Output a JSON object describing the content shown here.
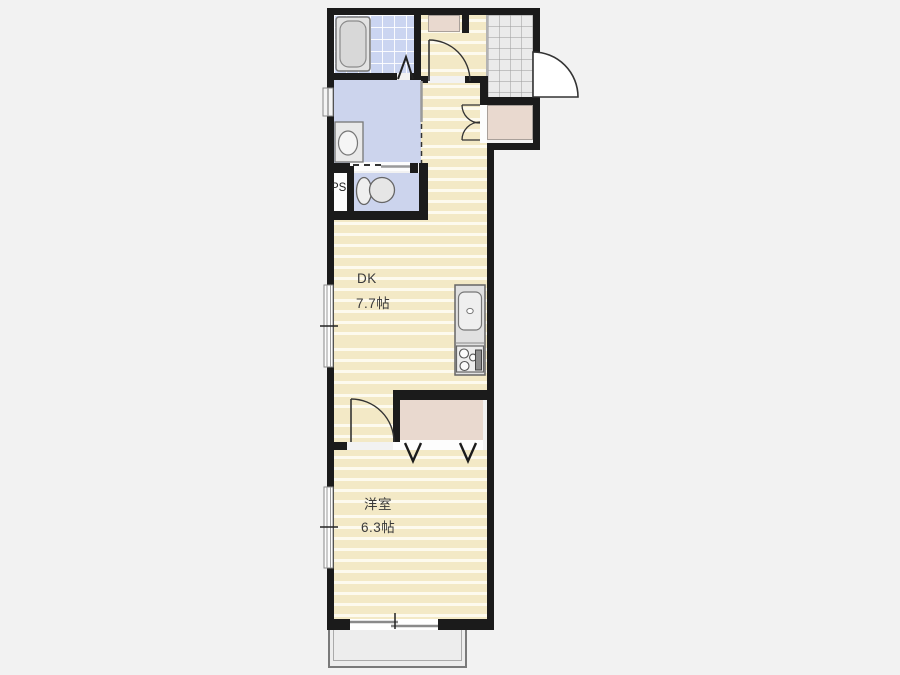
{
  "title": "apartment-floor-plan",
  "rooms": {
    "dk": {
      "label": "DK",
      "size": "7.7帖"
    },
    "western_room": {
      "label": "洋室",
      "size": "6.3帖"
    },
    "pipe_space": {
      "label": "PS"
    }
  },
  "colors": {
    "background": "#f2f2f2",
    "wall": "#1b1b1b",
    "floor_wood": "#f3e9c6",
    "floor_wet": "#ccd4ed",
    "tile_bath": "#cbd5f1",
    "tile_entry": "#ebebeb",
    "closet": "#e9d9cf",
    "fixture_fill": "#e3e3e3",
    "line": "#333333"
  }
}
